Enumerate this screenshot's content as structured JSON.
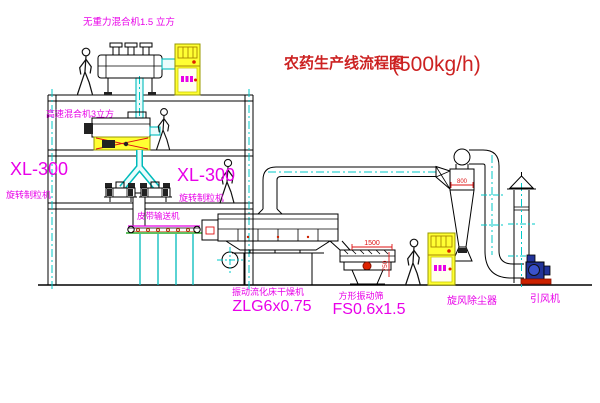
{
  "title": {
    "text": "农药生产线流程图",
    "capacity": "(500kg/h)"
  },
  "labels": {
    "no_gravity_mixer": "无重力混合机1.5 立方",
    "high_speed_mixer": "高速混合机3立方",
    "granulator_model_left": "XL-300",
    "granulator_name_left": "旋转制粒机",
    "granulator_model_center": "XL-300",
    "granulator_name_center": "旋转制粒机",
    "belt_conveyor": "皮带输送机",
    "dryer_name": "振动流化床干燥机",
    "dryer_model": "ZLG6x0.75",
    "sieve_name": "方形振动筛",
    "sieve_model": "FS0.6x1.5",
    "cyclone": "旋风除尘器",
    "fan": "引风机"
  },
  "dimensions": {
    "cyclone_inlet": "800",
    "sieve_width": "1500",
    "sieve_height": "750"
  },
  "colors": {
    "label": "#e800e8",
    "title": "#cc2222",
    "pipe_centerline": "#00c8c8",
    "cabinet": "#ffff33",
    "dimension": "#dd1111",
    "fan_body": "#223399",
    "fan_base": "#cc2200"
  }
}
